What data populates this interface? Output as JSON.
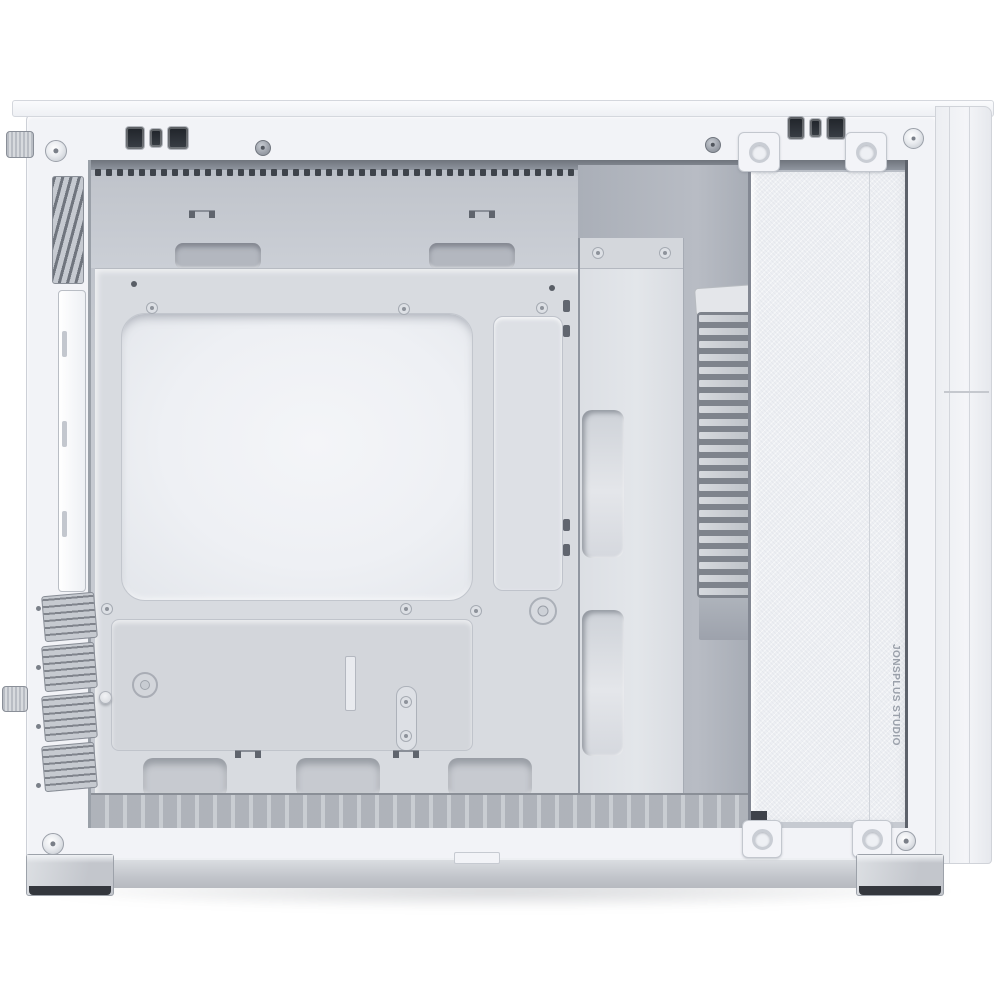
{
  "meta": {
    "subject": "White micro-ATX PC tower case, product photo, side view with side panel removed showing empty interior",
    "background_color": "#ffffff"
  },
  "branding": {
    "side_text": "JONSPLUS STUDIO",
    "text_color": "#9aa0aa"
  },
  "colors": {
    "frame_white": "#f2f3f7",
    "interior_wall": "#c5c9d0",
    "interior_shadow": "#a8adb6",
    "motherboard_tray": "#d8dbe0",
    "cpu_cutout": "#f1f2f6",
    "cable_column": "#e0e3e8",
    "grille_fin": "#ccd0d6",
    "grille_gap": "#7e838c",
    "front_panel": "#edeff3",
    "foot_rubber": "#34373d"
  },
  "decor": {
    "top_vent_dash_count": 52,
    "grille_fin_count": 22,
    "pci_slot_cover_count": 4,
    "top_cable_cutout_count": 2,
    "bottom_cable_cutout_count": 3
  }
}
